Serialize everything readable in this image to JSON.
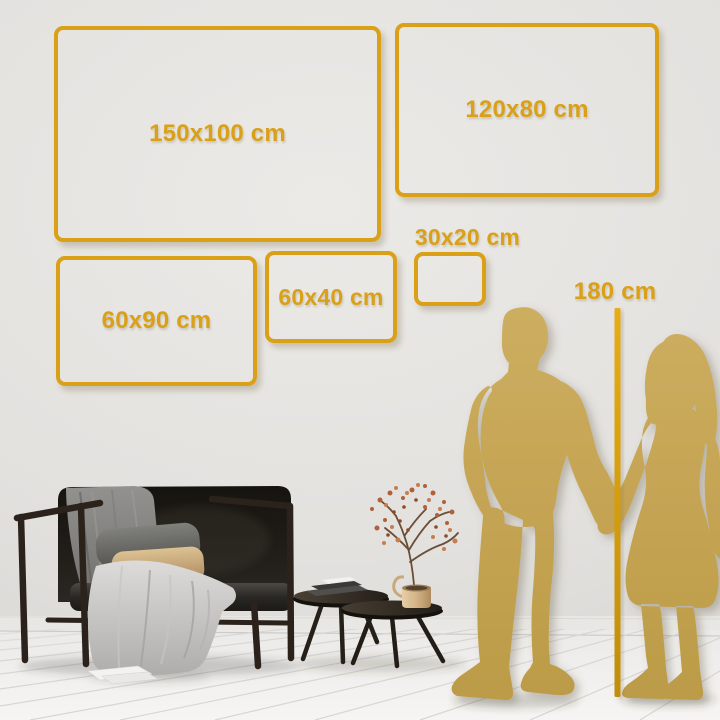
{
  "sizes": {
    "frames": [
      {
        "label": "150x100 cm"
      },
      {
        "label": "120x80 cm"
      },
      {
        "label": "60x90 cm"
      },
      {
        "label": "60x40 cm"
      },
      {
        "label": "30x20 cm"
      }
    ],
    "height_reference": {
      "label": "180 cm"
    }
  },
  "colors": {
    "accent_gold": "#D9A018",
    "silhouette_gold": "#C6A553",
    "wall": "#E3E1DE",
    "floor": "#F1F0EE"
  },
  "scene": {
    "items": [
      "sofa",
      "throw-blanket",
      "cushions",
      "nesting-coffee-tables",
      "books",
      "brass-vase",
      "dried-flower-branch",
      "man-silhouette",
      "woman-silhouette",
      "height-line",
      "wood-floor",
      "wall"
    ]
  }
}
